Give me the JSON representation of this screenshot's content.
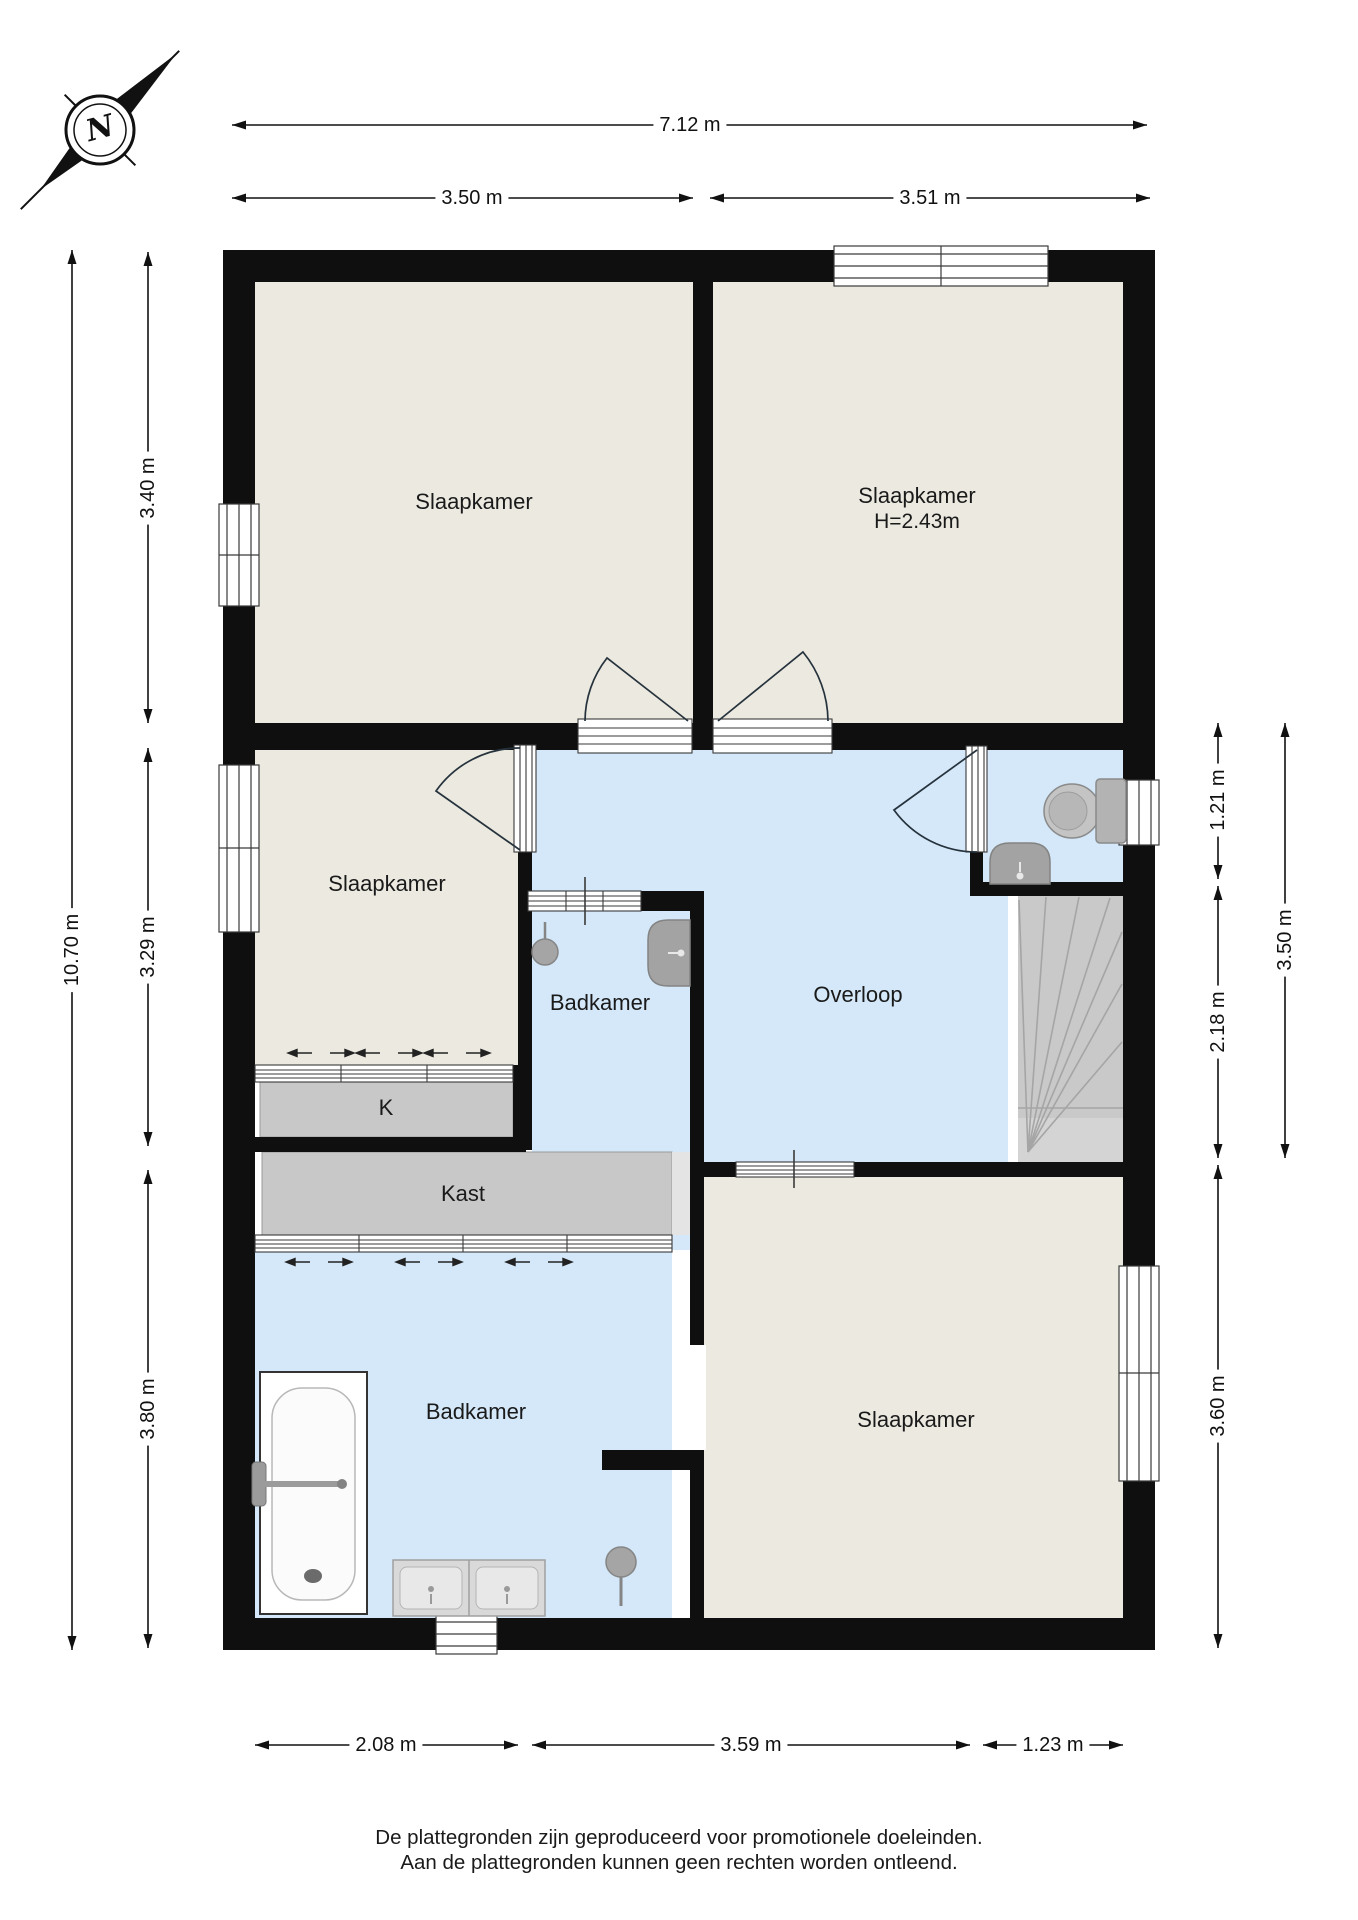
{
  "compass": {
    "label": "N"
  },
  "rooms": {
    "slaapkamer_top_left": {
      "label": "Slaapkamer"
    },
    "slaapkamer_top_right": {
      "label": "Slaapkamer",
      "height_note": "H=2.43m"
    },
    "slaapkamer_mid_left": {
      "label": "Slaapkamer"
    },
    "badkamer_mid": {
      "label": "Badkamer"
    },
    "overloop": {
      "label": "Overloop"
    },
    "closet_k": {
      "label": "K"
    },
    "kast": {
      "label": "Kast"
    },
    "badkamer_bottom": {
      "label": "Badkamer"
    },
    "slaapkamer_bottom_right": {
      "label": "Slaapkamer"
    }
  },
  "dimensions": {
    "top_total": "7.12 m",
    "top_left": "3.50 m",
    "top_right": "3.51 m",
    "left_total": "10.70 m",
    "left_top": "3.40 m",
    "left_mid": "3.29 m",
    "left_bottom": "3.80 m",
    "right_wc": "1.21 m",
    "right_stairs": "2.18 m",
    "right_mid_total": "3.50 m",
    "right_bottom": "3.60 m",
    "bottom_left": "2.08 m",
    "bottom_mid": "3.59 m",
    "bottom_right": "1.23 m"
  },
  "footer": {
    "line1": "De plattegronden zijn geproduceerd voor promotionele doeleinden.",
    "line2": "Aan de plattegronden kunnen geen rechten worden ontleend."
  },
  "colors": {
    "wall": "#0f0f0f",
    "dry_room": "#ebe9e0",
    "wet_room": "#d4e8f9",
    "closet": "#c8c8c8",
    "stairs": "#c9c9c9",
    "fixture": "#a9a9a9",
    "dimension_text": "#111111"
  }
}
